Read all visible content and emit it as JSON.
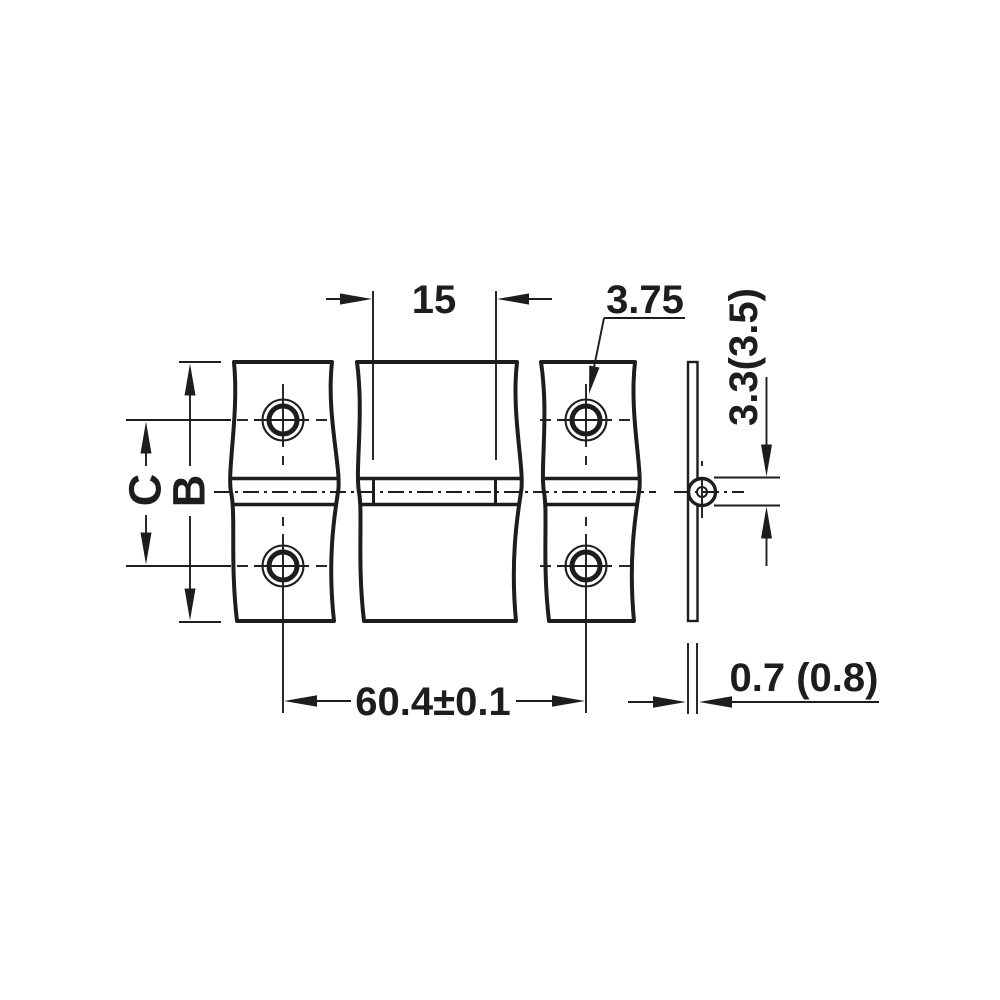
{
  "drawing": {
    "labels": {
      "knuckle_width": "15",
      "hole_diameter": "3.75",
      "knuckle_diameter": "3.3(3.5)",
      "dim_c": "C",
      "dim_b": "B",
      "hole_pitch": "60.4±0.1",
      "material_thickness": "0.7 (0.8)"
    },
    "colors": {
      "line": "#1d1d1b",
      "background": "#ffffff"
    }
  }
}
